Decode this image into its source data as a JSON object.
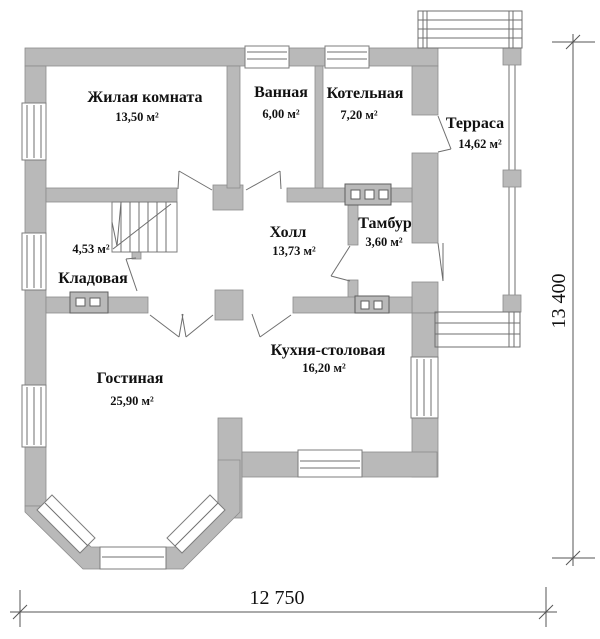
{
  "floor_plan": {
    "rooms": [
      {
        "name": "Жилая комната",
        "area": "13,50 м²"
      },
      {
        "name": "Ванная",
        "area": "6,00 м²"
      },
      {
        "name": "Котельная",
        "area": "7,20 м²"
      },
      {
        "name": "Терраса",
        "area": "14,62 м²"
      },
      {
        "name": "Холл",
        "area": "13,73 м²"
      },
      {
        "name": "Тамбур",
        "area": "3,60 м²"
      },
      {
        "name": "Кладовая",
        "area": "4,53 м²"
      },
      {
        "name": "Гостиная",
        "area": "25,90 м²"
      },
      {
        "name": "Кухня-столовая",
        "area": "16,20 м²"
      }
    ],
    "dimensions": {
      "bottom": "12 750",
      "right": "13 400"
    },
    "colors": {
      "wall_fill": "#b9b9b9",
      "wall_stroke": "#8c8c8c",
      "thin_line": "#6f6f6f",
      "text": "#111111",
      "background": "#ffffff"
    }
  }
}
